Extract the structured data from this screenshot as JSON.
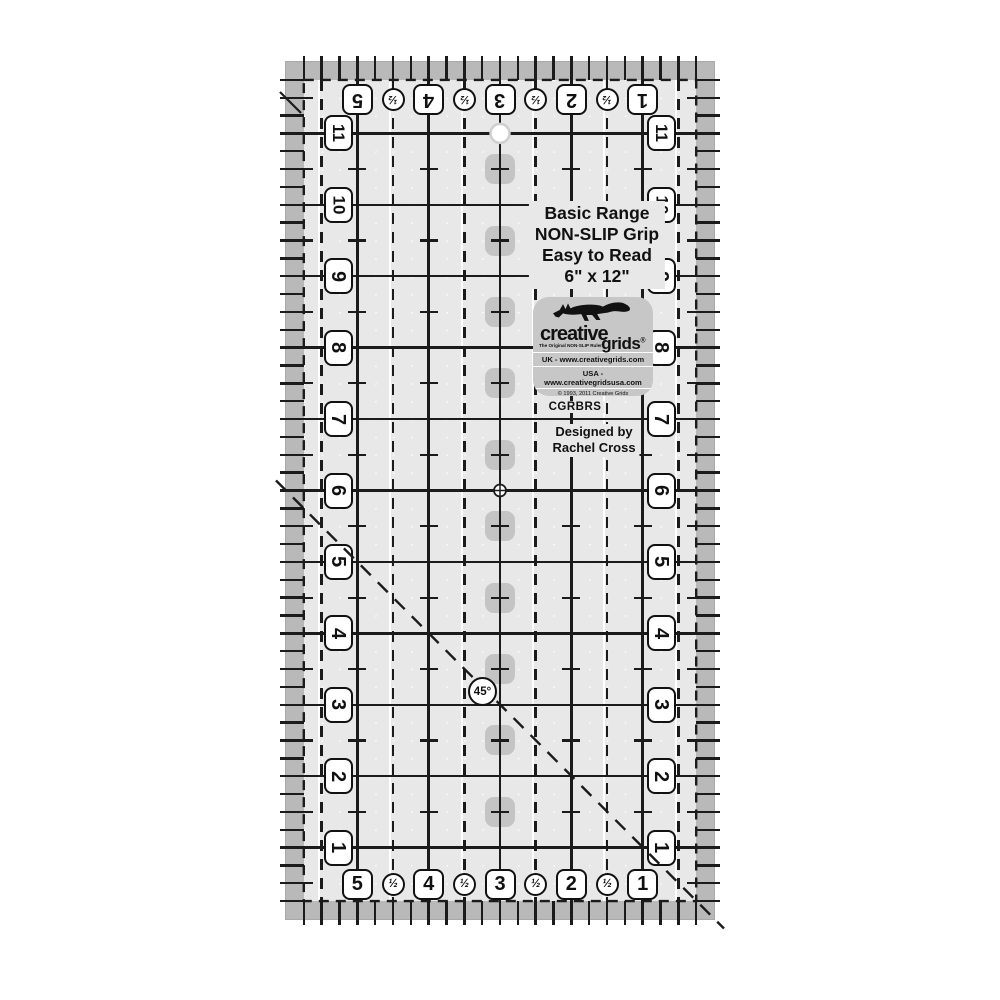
{
  "product": {
    "info_lines": [
      "Basic Range",
      "NON-SLIP Grip",
      "Easy to Read",
      "6\" x 12\""
    ],
    "brand": {
      "name_top": "creative",
      "name_bottom": "grids",
      "registered": "®",
      "tagline": "The Original NON-SLIP Ruler",
      "uk_line": "UK - www.creativegrids.com",
      "usa_line": "USA - www.creativegridsusa.com",
      "copyright": "© 1993, 2011 Creative Grids",
      "made_in": "MADE IN USA"
    },
    "sku": "CGRBRS",
    "designed_by_line1": "Designed by",
    "designed_by_line2": "Rachel Cross",
    "angle_label": "45°"
  },
  "ruler": {
    "width_inches": 6,
    "height_inches": 12,
    "top_numbers": [
      "5",
      "4",
      "3",
      "2",
      "1"
    ],
    "bottom_numbers": [
      "5",
      "4",
      "3",
      "2",
      "1"
    ],
    "left_numbers": [
      "11",
      "10",
      "9",
      "8",
      "7",
      "6",
      "5",
      "4",
      "3",
      "2",
      "1"
    ],
    "right_numbers": [
      "11",
      "10",
      "9",
      "8",
      "7",
      "6",
      "5",
      "4",
      "3",
      "2",
      "1"
    ],
    "half_symbol": "½"
  },
  "colors": {
    "line": "#1b1b1b",
    "band": "#b9b9b9",
    "interior": "#e8e8e8",
    "pad": "#c4c4c4",
    "brand_badge_bg": "#c7c7c7"
  }
}
